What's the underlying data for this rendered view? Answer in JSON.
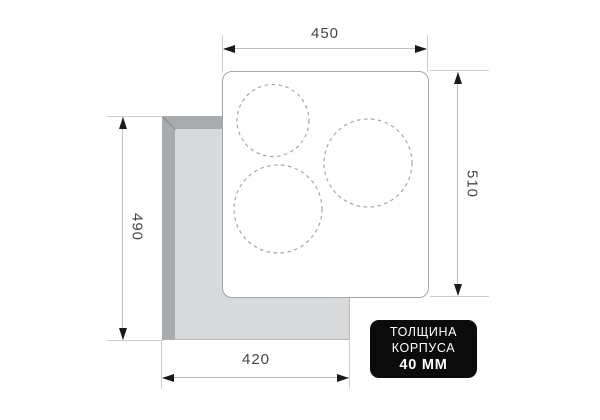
{
  "dimensions": {
    "top_width": {
      "value": "450"
    },
    "right_height": {
      "value": "510"
    },
    "left_height": {
      "value": "490"
    },
    "bottom_width": {
      "value": "420"
    }
  },
  "badge": {
    "line1": "ТОЛЩИНА",
    "line2": "КОРПУСА",
    "line3": "40 ММ"
  },
  "figure": {
    "burner_count": 3
  },
  "colors": {
    "background": "#ffffff",
    "cutout_rim": "#a9acaf",
    "cutout_opening": "#d8d9da",
    "panel_outline": "#a3a6a9",
    "burner_stroke": "#a2a7aa",
    "dimension_line": "#bcbfc1",
    "arrowhead": "#1a1a1a",
    "dimension_text": "#44484b",
    "badge_background": "#0b0b0c",
    "badge_text": "#ffffff"
  }
}
